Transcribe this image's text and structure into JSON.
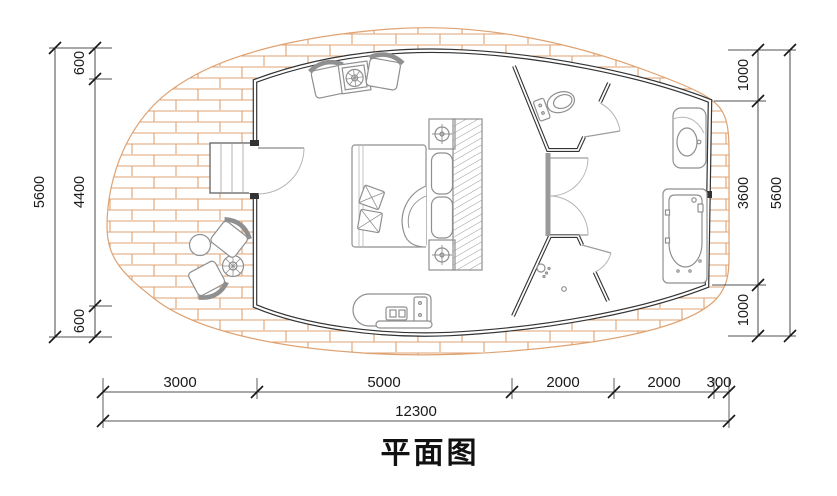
{
  "title": "平面图",
  "dimensions": {
    "left": {
      "total": "5600",
      "chain": [
        "600",
        "4400",
        "600"
      ]
    },
    "right": {
      "total": "5600",
      "chain": [
        "1000",
        "3600",
        "1000"
      ]
    },
    "bottom": {
      "total": "12300",
      "chain": [
        "3000",
        "5000",
        "2000",
        "2000",
        "300"
      ]
    }
  },
  "fixtures": [
    "entry-step",
    "entry-door",
    "lounge-chair",
    "side-table",
    "bed",
    "pillows",
    "blanket",
    "nightstand-lamp",
    "headboard-cushion",
    "wardrobe",
    "kitchenette-counter",
    "toilet",
    "shower-head",
    "floor-drain",
    "washbasin",
    "bathtub",
    "outdoor-chair",
    "outdoor-round-table",
    "plant-table",
    "wood-deck"
  ],
  "colors": {
    "deck_hatch": "#dfa271",
    "wall": "#333333",
    "furniture": "#8f8f8f",
    "dimension": "#1a1a1a",
    "background": "#ffffff"
  }
}
